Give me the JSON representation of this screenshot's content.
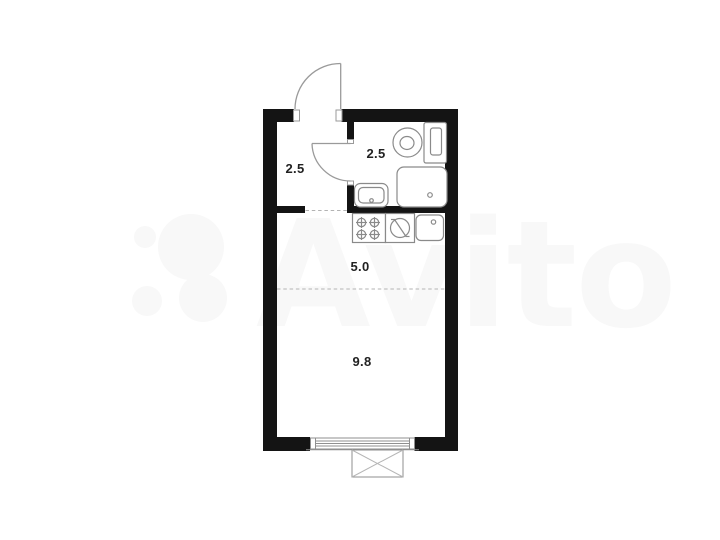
{
  "watermark": {
    "brand_text": "Avito",
    "color": "#f8f8f8",
    "logo_icon": "avito-four-circles-logo"
  },
  "floorplan": {
    "type": "studio-apartment-plan",
    "wall_color": "#141414",
    "fixture_line_color": "#8a8a8a",
    "dashed_line_color": "#b3b3b3",
    "label_color": "#222222",
    "rooms": [
      {
        "name": "hallway",
        "area_label": "2.5"
      },
      {
        "name": "bathroom",
        "area_label": "2.5"
      },
      {
        "name": "kitchen",
        "area_label": "5.0"
      },
      {
        "name": "living-room",
        "area_label": "9.8"
      }
    ],
    "fixtures": [
      "entrance-door",
      "interior-door",
      "toilet",
      "shower",
      "bathroom-sink",
      "stove",
      "washing-machine",
      "kitchen-sink",
      "window",
      "balcony"
    ]
  }
}
